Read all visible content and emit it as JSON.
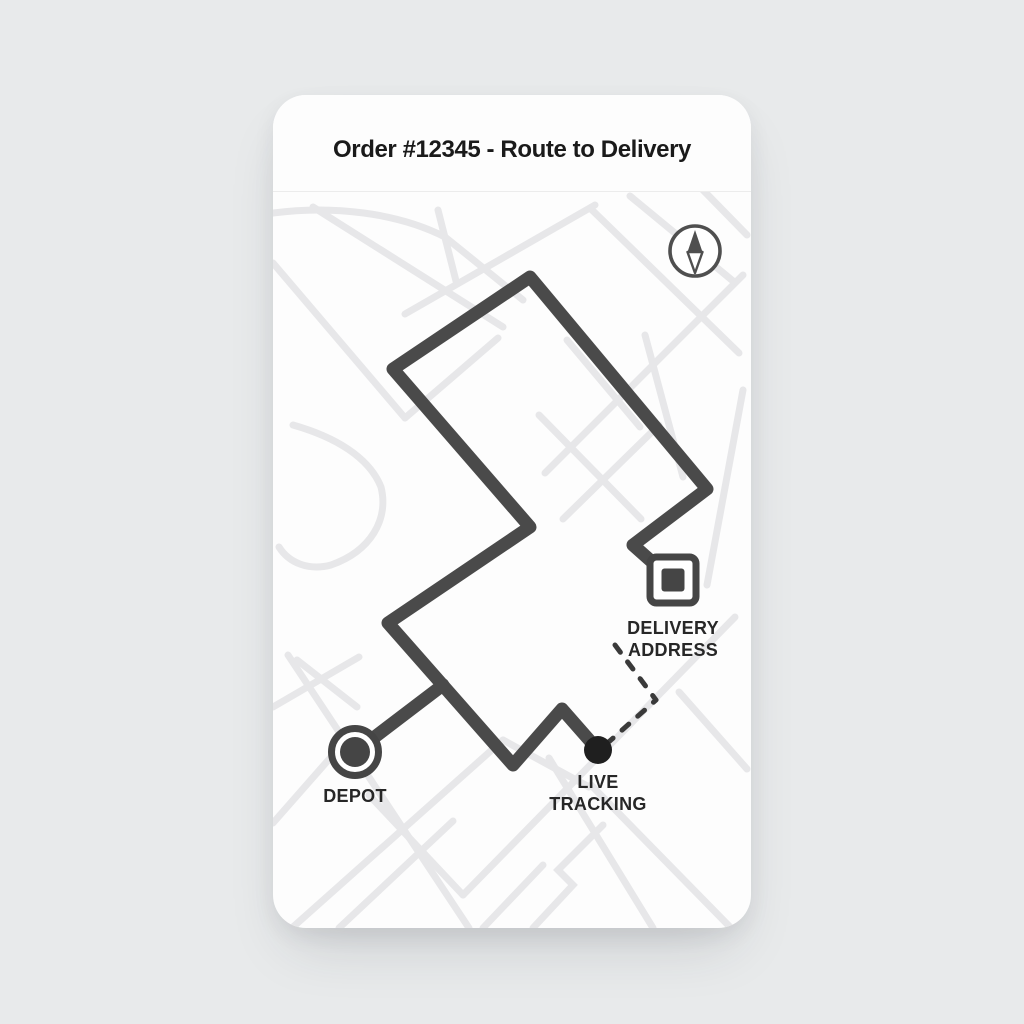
{
  "colors": {
    "page_bg": "#e8eaeb",
    "card_bg": "#fdfdfd",
    "divider": "#ececec",
    "street": "#e7e7e9",
    "route": "#4a4a4a",
    "dashed": "#3a3a3a",
    "marker": "#454545",
    "live_dot": "#1f1f1f",
    "compass": "#4f4f4f",
    "text_title": "#1a1a1a",
    "text_label": "#272727"
  },
  "card": {
    "title": "Order #12345 - Route to Delivery"
  },
  "map": {
    "size": {
      "width": 478,
      "height": 833
    },
    "streets": [
      "M 0,118 C 60,110 125,118 172,142",
      "M 0,168 L 132,323",
      "M 40,112 L 230,232",
      "M 132,219 L 322,110",
      "M 470,180 L 272,378",
      "M 318,114 L 466,258",
      "M 357,101 L 460,186",
      "M 430,95 L 474,140",
      "M 372,240 L 410,382",
      "M 470,295 L 434,490",
      "M 20,330 C 62,342 96,362 108,392 C 116,424 98,456 58,470 C 36,476 16,468 6,452",
      "M 165,115 L 183,186",
      "M 172,142 L 250,205",
      "M 294,245 L 367,332",
      "M 132,323 L 225,243",
      "M 266,320 L 368,424",
      "M 290,424 L 386,330",
      "M 0,612 L 86,562",
      "M 24,565 L 84,612",
      "M 15,560 L 196,833",
      "M 20,832 L 230,645",
      "M 190,800 L 462,522",
      "M 276,663 L 380,833",
      "M 230,645 L 316,692",
      "M 406,597 L 474,674",
      "M 318,690 L 458,833",
      "M 58,662 L 0,728",
      "M 96,700 L 190,800",
      "M 66,833 L 180,726",
      "M 210,833 L 270,770",
      "M 260,833 L 300,790 L 285,775 L 330,730"
    ],
    "route": {
      "width": 13,
      "main": [
        [
          378,
          466
        ],
        [
          360,
          450
        ],
        [
          434,
          394
        ],
        [
          257,
          182
        ],
        [
          120,
          274
        ],
        [
          257,
          432
        ],
        [
          115,
          528
        ],
        [
          240,
          670
        ],
        [
          289,
          614
        ],
        [
          325,
          655
        ]
      ],
      "depot_spur": [
        [
          82,
          657
        ],
        [
          170,
          590
        ]
      ]
    },
    "dashed_connector": [
      [
        342,
        550
      ],
      [
        383,
        605
      ],
      [
        330,
        652
      ]
    ],
    "markers": {
      "depot": {
        "x": 82,
        "y": 657,
        "label": "DEPOT"
      },
      "delivery": {
        "x": 400,
        "y": 485,
        "label_lines": [
          "DELIVERY",
          "ADDRESS"
        ]
      },
      "live": {
        "x": 325,
        "y": 655,
        "label_lines": [
          "LIVE",
          "TRACKING"
        ]
      }
    },
    "compass": {
      "x": 422,
      "y": 156
    }
  }
}
